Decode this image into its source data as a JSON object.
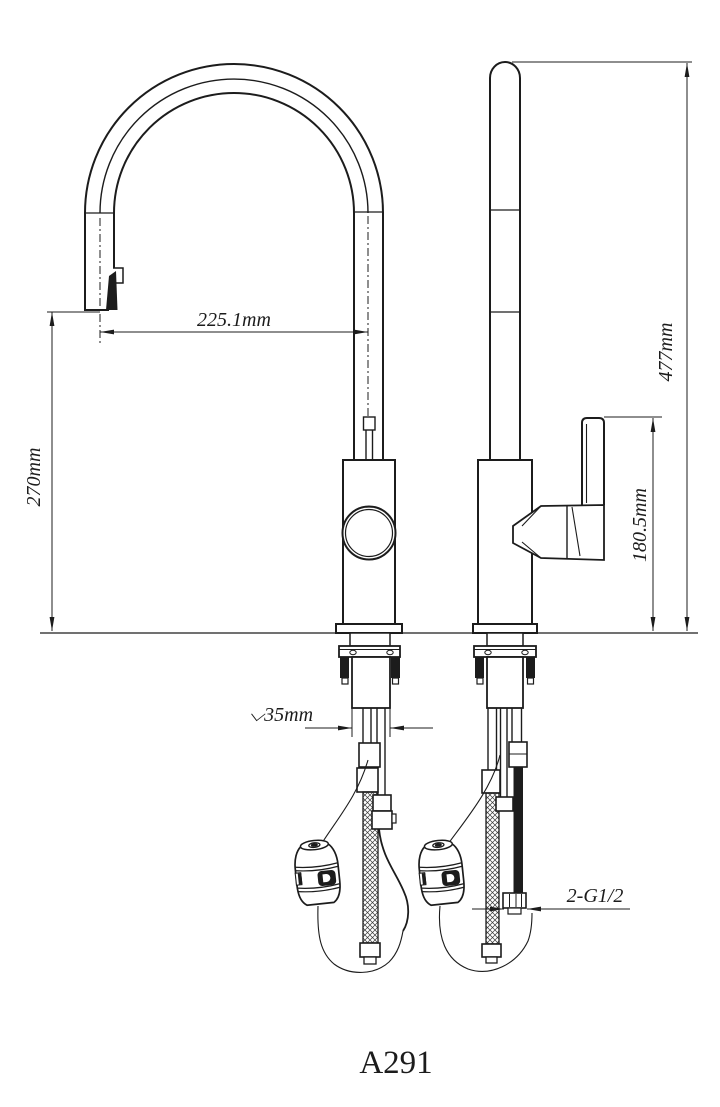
{
  "drawing": {
    "model_label": "A291",
    "ink_color": "#1c1c1c",
    "paper_color": "#ffffff",
    "dimensions": {
      "spout_reach": {
        "label": "225.1mm"
      },
      "spout_height": {
        "label": "270mm"
      },
      "overall_height": {
        "label": "477mm"
      },
      "handle_height": {
        "label": "180.5mm"
      },
      "shank_diameter": {
        "label": "⌵35mm"
      },
      "supply_thread": {
        "label": "2-G1/2"
      }
    }
  }
}
